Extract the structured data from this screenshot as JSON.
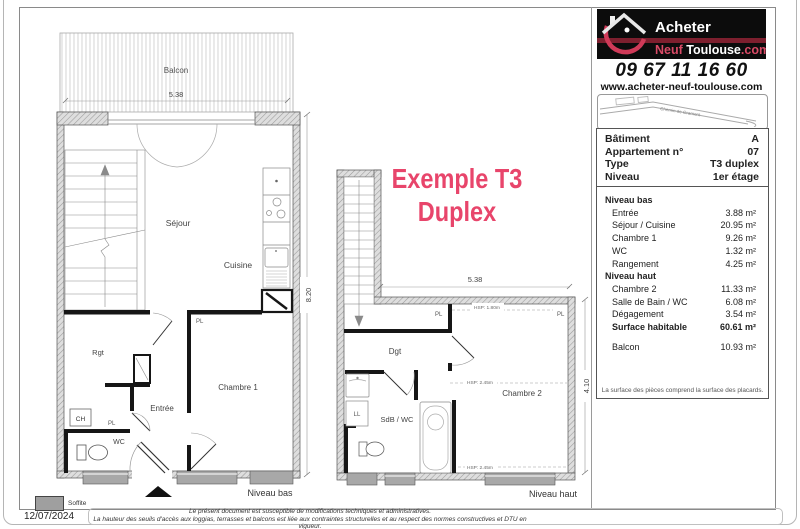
{
  "colors": {
    "accent_pink": "#e8456b",
    "logo_pink": "#cf3a58",
    "logo_stripe": "#7d1f2e"
  },
  "sidebar": {
    "logo": {
      "acheter": "Acheter",
      "neuf": "Neuf ",
      "toulouse": "Toulouse",
      "dotcom": ".com"
    },
    "phone": "09 67 11 16 60",
    "website": "www.acheter-neuf-toulouse.com",
    "map_label": "Chemin de Gramont"
  },
  "title": {
    "line1": "Exemple T3",
    "line2": "Duplex"
  },
  "info": {
    "header_rows": [
      {
        "label": "Bâtiment",
        "value": "A"
      },
      {
        "label": "Appartement n°",
        "value": "07"
      },
      {
        "label": "Type",
        "value": "T3 duplex"
      },
      {
        "label": "Niveau",
        "value": "1er étage"
      }
    ],
    "sections": [
      {
        "title": "Niveau bas",
        "rows": [
          {
            "label": "Entrée",
            "value": "3.88 m²"
          },
          {
            "label": "Séjour / Cuisine",
            "value": "20.95 m²"
          },
          {
            "label": "Chambre 1",
            "value": "9.26 m²"
          },
          {
            "label": "WC",
            "value": "1.32 m²"
          },
          {
            "label": "Rangement",
            "value": "4.25 m²"
          }
        ]
      },
      {
        "title": "Niveau haut",
        "rows": [
          {
            "label": "Chambre 2",
            "value": "11.33 m²"
          },
          {
            "label": "Salle de Bain / WC",
            "value": "6.08 m²"
          },
          {
            "label": "Dégagement",
            "value": "3.54 m²"
          }
        ]
      }
    ],
    "total": {
      "label": "Surface habitable",
      "value": "60.61 m²"
    },
    "balcony": {
      "label": "Balcon",
      "value": "10.93 m²"
    },
    "footnote": "La surface des pièces comprend la surface des placards."
  },
  "plan_bas": {
    "balcony": "Balcon",
    "dim_top": "5.38",
    "dim_right": "8.20",
    "sejour": "Séjour",
    "cuisine": "Cuisine",
    "rgt": "Rgt",
    "entree": "Entrée",
    "chambre1": "Chambre 1",
    "wc": "WC",
    "ch": "CH",
    "pl_entree": "PL",
    "pl_wc": "PL",
    "caption": "Niveau bas"
  },
  "plan_haut": {
    "dim_top": "5.38",
    "dim_right": "4.10",
    "dgt": "Dgt",
    "chambre2": "Chambre 2",
    "sdb": "SdB / WC",
    "ll": "LL",
    "pl_left": "PL",
    "pl_right": "PL",
    "hsp_low": "HSP: 1.80m",
    "hsp_1": "HSP: 2.45m",
    "hsp_2": "HSP: 2.45m",
    "caption": "Niveau haut"
  },
  "footer": {
    "soffite": "Soffite",
    "date": "12/07/2024",
    "disclaimer1": "Le présent document est susceptible de modifications techniques et administratives.",
    "disclaimer2": "La hauteur des seuils d'accès aux loggias, terrasses et balcons est liée aux contraintes structurelles et au respect des normes constructives et DTU en vigueur."
  }
}
